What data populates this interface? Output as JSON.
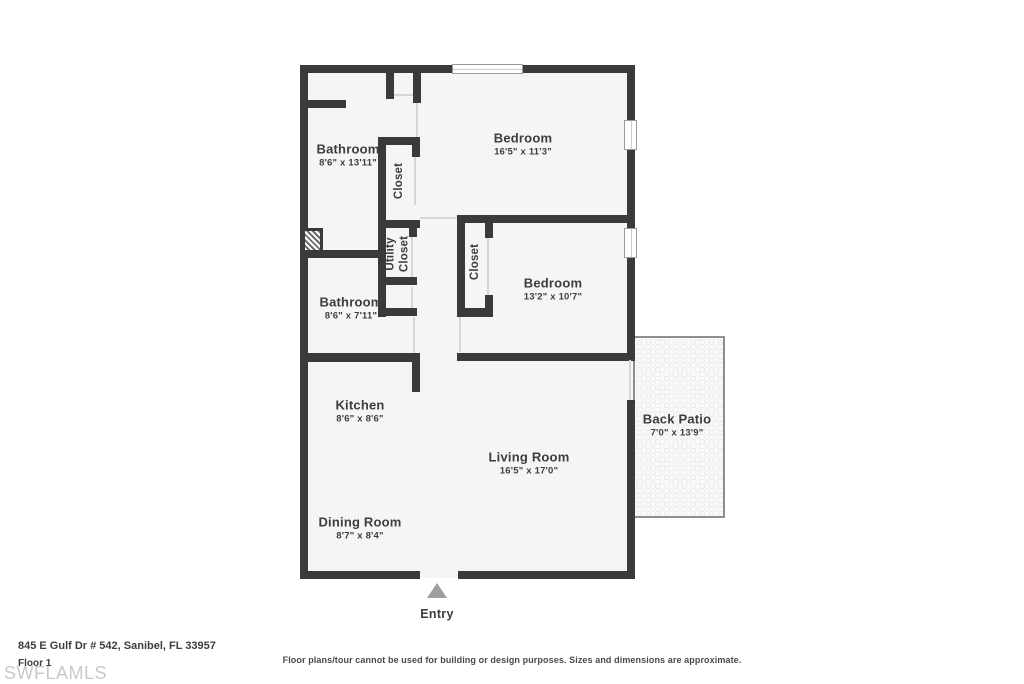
{
  "plan": {
    "rooms": [
      {
        "id": "bathroom-1",
        "name": "Bathroom",
        "dims": "8'6\" x 13'11\""
      },
      {
        "id": "closet-1",
        "name": "Closet",
        "dims": ""
      },
      {
        "id": "bedroom-1",
        "name": "Bedroom",
        "dims": "16'5\" x 11'3\""
      },
      {
        "id": "utility-closet",
        "line1": "Utility",
        "line2": "Closet"
      },
      {
        "id": "closet-2",
        "name": "Closet",
        "dims": ""
      },
      {
        "id": "bathroom-2",
        "name": "Bathroom",
        "dims": "8'6\" x 7'11\""
      },
      {
        "id": "bedroom-2",
        "name": "Bedroom",
        "dims": "13'2\" x 10'7\""
      },
      {
        "id": "kitchen",
        "name": "Kitchen",
        "dims": "8'6\" x 8'6\""
      },
      {
        "id": "living-room",
        "name": "Living Room",
        "dims": "16'5\" x 17'0\""
      },
      {
        "id": "dining-room",
        "name": "Dining Room",
        "dims": "8'7\" x 8'4\""
      },
      {
        "id": "back-patio",
        "name": "Back Patio",
        "dims": "7'0\" x 13'9\""
      }
    ],
    "entry_label": "Entry"
  },
  "footer": {
    "address": "845 E Gulf Dr # 542, Sanibel, FL 33957",
    "floor_label": "Floor 1",
    "watermark": "SWFLAMLS",
    "disclaimer": "Floor plans/tour cannot be used for building or design purposes. Sizes and dimensions are approximate."
  },
  "colors": {
    "wall": "#3a3a3a",
    "room_fill": "#f5f5f5",
    "patio_border": "#8f8f8f",
    "door_opening": "#d6d6d6",
    "entry_arrow": "#9e9e9e",
    "label_text": "#3d3d3d",
    "watermark_text": "#c9c9c9"
  }
}
